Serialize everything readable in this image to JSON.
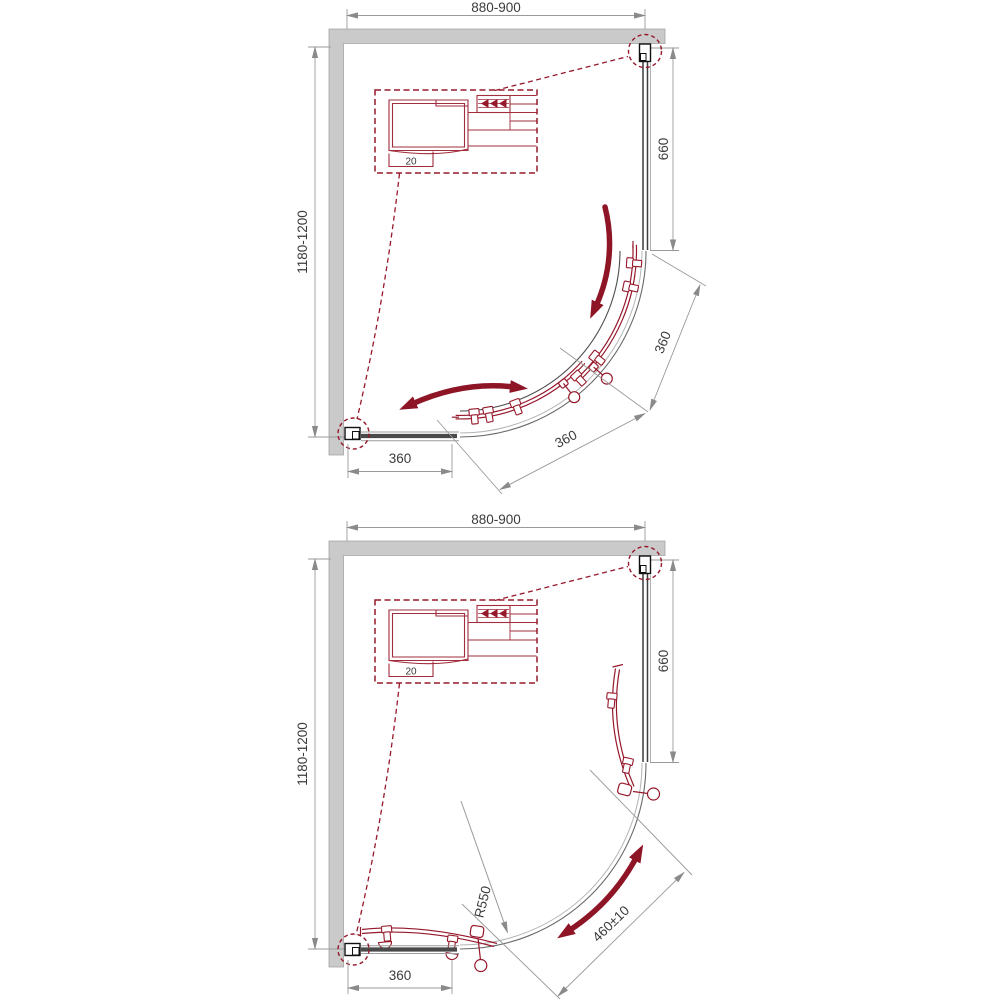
{
  "palette": {
    "accent_red": "#96182b",
    "arrow_red": "#8e1526",
    "wall_gray": "#cacaca",
    "dim_gray": "#9a9a9a",
    "text_gray": "#3b3b3b"
  },
  "top_diagram": {
    "width_dim": "880-900",
    "height_dim": "1180-1200",
    "right_panel_dim": "660",
    "bottom_panel_dim": "360",
    "lower_door_dim": "360",
    "upper_door_dim": "360",
    "detail_dim": "20"
  },
  "bottom_diagram": {
    "width_dim": "880-900",
    "height_dim": "1180-1200",
    "right_panel_dim": "660",
    "bottom_panel_dim": "360",
    "radius_dim": "R550",
    "opening_dim": "460±10",
    "detail_dim": "20"
  }
}
